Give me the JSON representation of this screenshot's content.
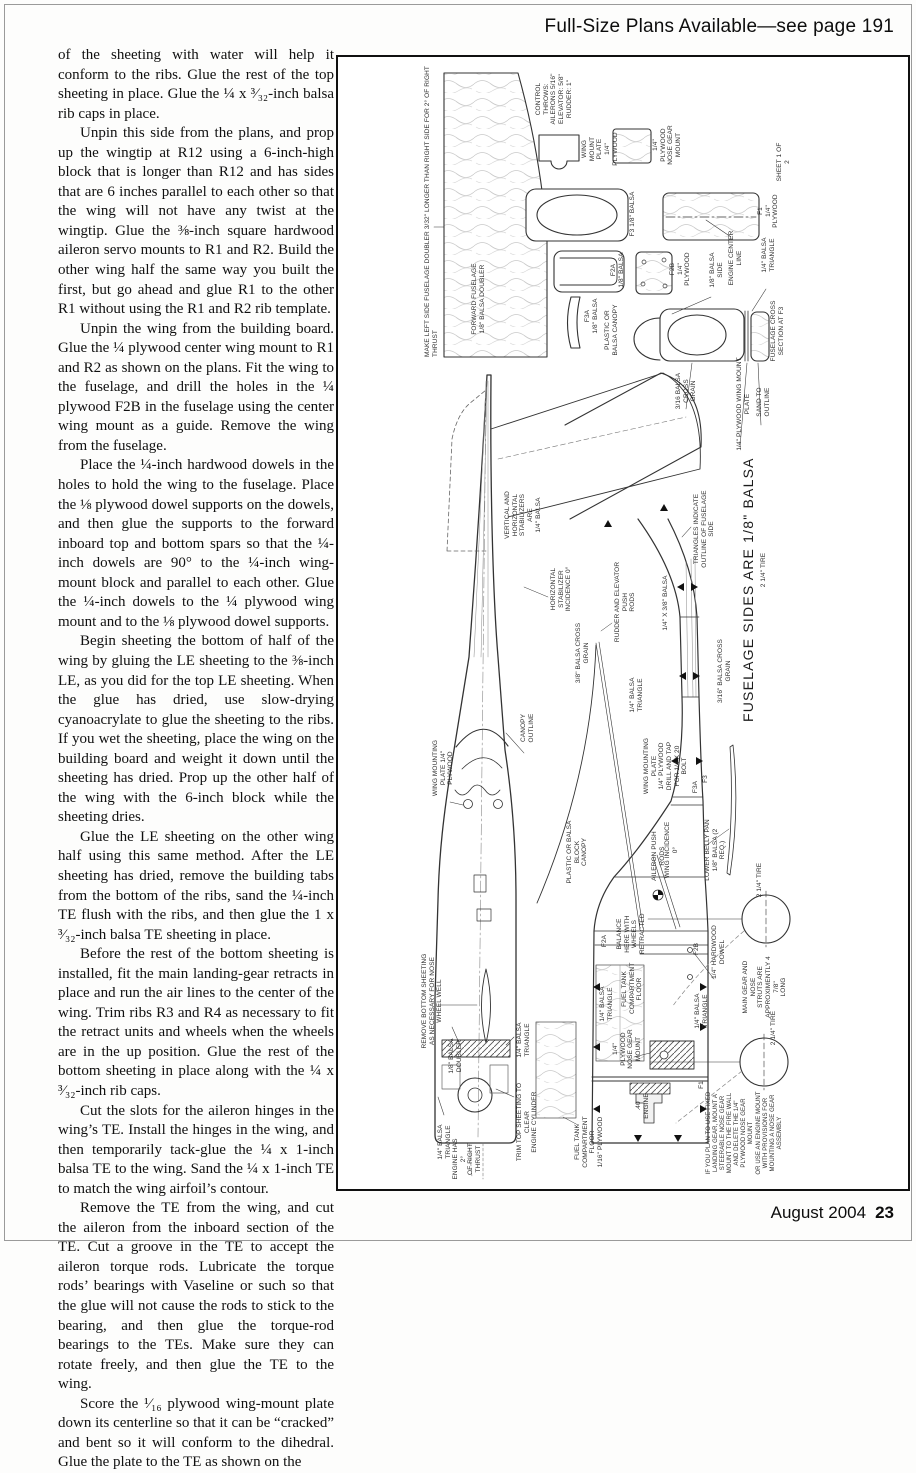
{
  "header": {
    "plans_notice": "Full-Size Plans Available—see page 191"
  },
  "footer": {
    "issue": "August 2004",
    "page_number": "23"
  },
  "article": {
    "paragraphs": [
      "of the sheeting with water will help it conform to the ribs. Glue the rest of the top sheeting in place. Glue the ¼ x ³⁄₃₂-inch balsa rib caps in place.",
      "Unpin this side from the plans, and prop up the wingtip at R12 using a 6-inch-high block that is longer than R12 and has sides that are 6 inches parallel to each other so that the wing will not have any twist at the wingtip. Glue the ⅜-inch square hardwood aileron servo mounts to R1 and R2. Build the other wing half the same way you built the first, but go ahead and glue R1 to the other R1 without using the R1 and R2 rib template.",
      "Unpin the wing from the building board. Glue the ¼ plywood center wing mount to R1 and R2 as shown on the plans. Fit the wing to the fuselage, and drill the holes in the ¼ plywood F2B in the fuselage using the center wing mount as a guide. Remove the wing from the fuselage.",
      "Place the ¼-inch hardwood dowels in the holes to hold the wing to the fuselage. Place the ⅛ plywood dowel supports on the dowels, and then glue the supports to the forward inboard top and bottom spars so that the ¼-inch dowels are 90° to the ¼-inch wing-mount block and parallel to each other. Glue the ¼-inch dowels to the ¼ plywood wing mount and to the ⅛ plywood dowel supports.",
      "Begin sheeting the bottom of half of the wing by gluing the LE sheeting to the ⅜-inch LE, as you did for the top LE sheeting. When the glue has dried, use slow-drying cyanoacrylate to glue the sheeting to the ribs. If you wet the sheeting, place the wing on the building board and weight it down until the sheeting has dried. Prop up the other half of the wing with the 6-inch block while the sheeting dries.",
      "Glue the LE sheeting on the other wing half using this same method. After the LE sheeting has dried, remove the building tabs from the bottom of the ribs, sand the ¼-inch TE flush with the ribs, and then glue the 1 x ³⁄₃₂-inch balsa TE sheeting in place.",
      "Before the rest of the bottom sheeting is installed, fit the main landing-gear retracts in place and run the air lines to the center of the wing. Trim ribs R3 and R4 as necessary to fit the retract units and wheels when the wheels are in the up position. Glue the rest of the bottom sheeting in place along with the ¼ x ³⁄₃₂-inch rib caps.",
      "Cut the slots for the aileron hinges in the wing’s TE. Install the hinges in the wing, and then temporarily tack-glue the ¼ x 1-inch balsa TE to the wing. Sand the ¼ x 1-inch TE to match the wing airfoil’s contour.",
      "Remove the TE from the wing, and cut the aileron from the inboard section of the TE. Cut a groove in the TE to accept the aileron torque rods. Lubricate the torque rods’ bearings with Vaseline or such so that the glue will not cause the rods to stick to the bearing, and then glue the torque-rod bearings to the TEs. Make sure they can rotate freely, and then glue the TE to the wing.",
      "Score the ¹⁄₁₆ plywood wing-mount plate down its centerline so that it can be “cracked” and bent so it will conform to the dihedral. Glue the plate to the TE as shown on the"
    ]
  },
  "plan": {
    "labels": {
      "make_left_side": "MAKE LEFT SIDE FUSELAGE DOUBLER 3/32\" LONGER THAN RIGHT SIDE FOR 2° OF RIGHT THRUST",
      "forward_fuselage": "FORWARD FUSELAGE\n1/8\" BALSA DOUBLER",
      "control_throws": "CONTROL THROWS:\nAILERONS 5/16\"\nELEVATOR: 5/8\"\nRUDDER: 1\"",
      "wing_mount_plate": "WING MOUNT\nPLATE\n1/4\" PLYWOOD",
      "nose_gear_mount": "1/4\" PLYWOOD\nNOSE GEAR\nMOUNT",
      "f3": "F3 1/8\" BALSA",
      "f2a": "F2A\n1/8\" BALSA",
      "f2b": "F2B\n1/4\" PLYWOOD",
      "f1": "F1\n1/4\" PLYWOOD",
      "sheet": "SHEET 1 OF 2",
      "f3a": "F3A\n1/8\" BALSA",
      "plastic_canopy": "PLASTIC OR\nBALSA CANOPY",
      "balsa_side": "1/8\" BALSA SIDE",
      "engine_center_line": "ENGINE CENTER LINE",
      "balsa_triangle_cs": "1/4\" BALSA TRIANGLE",
      "cross_section_f3": "FUSELAGE CROSS SECTION AT F3",
      "cross_grain_316": "3/16 BALSA\nCROSS GRAIN",
      "wing_mount_plate_cs": "1/4\" PLYWOOD WING MOUNT PLATE",
      "sand_to_outline": "SAND TO OUTLINE",
      "stabilizers": "VERTICAL AND\nHORIZONTAL\nSTABILIZERS ARE\n1/4\" BALSA",
      "stab_incidence": "HORIZONTAL STABILIZER\nINCIDENCE 0°",
      "pushrods": "RUDDER AND ELEVATOR PUSH\nRODS",
      "cross_grain_38": "3/8\" BALSA CROSS GRAIN",
      "balsa_14x38": "1/4\" X 3/8\" BALSA",
      "cross_grain_316b": "3/16\" BALSA CROSS GRAIN",
      "triangles_indicate": "TRIANGLES INDICATE\nOUTLINE OF FUSELAGE SIDE",
      "fuselage_sides": "FUSELAGE SIDES ARE 1/8\" BALSA",
      "canopy_outline": "CANOPY OUTLINE",
      "wing_mounting_plate": "WING MOUNTING\nPLATE 1/4\" PLYWOOD",
      "balsa_triangle_mid": "1/4\" BALSA TRIANGLE",
      "wing_mounting_plate_tap": "WING MOUNTING\nPLATE\n1/4\" PLYWOOD\nDRILL AND TAP\nFOR 1/4 X 20\nBOLT",
      "plastic_block_canopy": "PLASTIC OR BALSA BLOCK\nCANOPY",
      "aileron_pushrods": "AILERON PUSH RODS",
      "wing_incidence": "WING INCIDENCE 0°",
      "lower_belly_pan": "LOWER BELLY PAN\n1/8\" BALSA (2 REQ.)",
      "tire_a": "2 1/4\" TIRE",
      "tire_b": "2 1/4\" TIRE",
      "tire_c": "2 1/4\" TIRE",
      "balance": "BALANCE\nHERE WITH\nWHEELS\nRETRACTED",
      "f2a_small": "F2A",
      "f2b_small": "F2B",
      "f1_small": "F1",
      "f3_small": "F3",
      "f3a_small": "F3A",
      "hardwood_dowel": "1/4\" HARDWOOD DOWEL",
      "balsa_triangle_ft": "1/4\" BALSA\nTRIANGLE",
      "fuel_tank_floor": "FUEL TANK\nCOMPARTMENT\nFLOOR",
      "nose_gear_mount2": "1/4\" PLYWOOD\nNOSE GEAR\nMOUNT",
      "balsa_triangle_r": "1/4\" BALSA\nTRIANGLE",
      "main_gear_struts": "MAIN GEAR AND NOSE\nSTRUTS ARE\nAPPROXIMENTLY 4 7/8\"\nLONG",
      "engine_40": ".40 ENGINE",
      "fixed_gear_note": "IF YOU PLAN TO USE FIXED\nLANDING GEAR, MOUNT A\nSTEERABLE NOSE GEAR\nMOUNT TO THE FIRE WALL\nAND DELETE THE 1/4\"\nPLYWOOD NOSE GEAR MOUNT\nOR USE AN ENGINE MOUNT\nWITH PROVISIONS FOR\nMOUNTING A NOSE GEAR\nASSEMBLY",
      "remove_bottom_sheeting": "REMOVE BOTTOM SHEETING\nAS NECESSARY FOR NOSE WHEEL WELL",
      "balsa_doubler": "1/8\" BALSA DOUBLER",
      "balsa_triangle_b1": "1/4\" BALSA TRIANGLE",
      "trim_top_sheeting": "TRIM TOP SHEETING TO CLEAR\nENGINE CYLINDER",
      "balsa_triangle_b2": "1/4\" BALSA TRIANGLE",
      "engine_thrust": "ENGINE HAS 2°\nOF RIGHT\nTHRUST",
      "fuel_tank_floor_ply": "FUEL TANK\nCOMPARTMENT FLOOR\n1/16\" PLYWOOD"
    }
  }
}
